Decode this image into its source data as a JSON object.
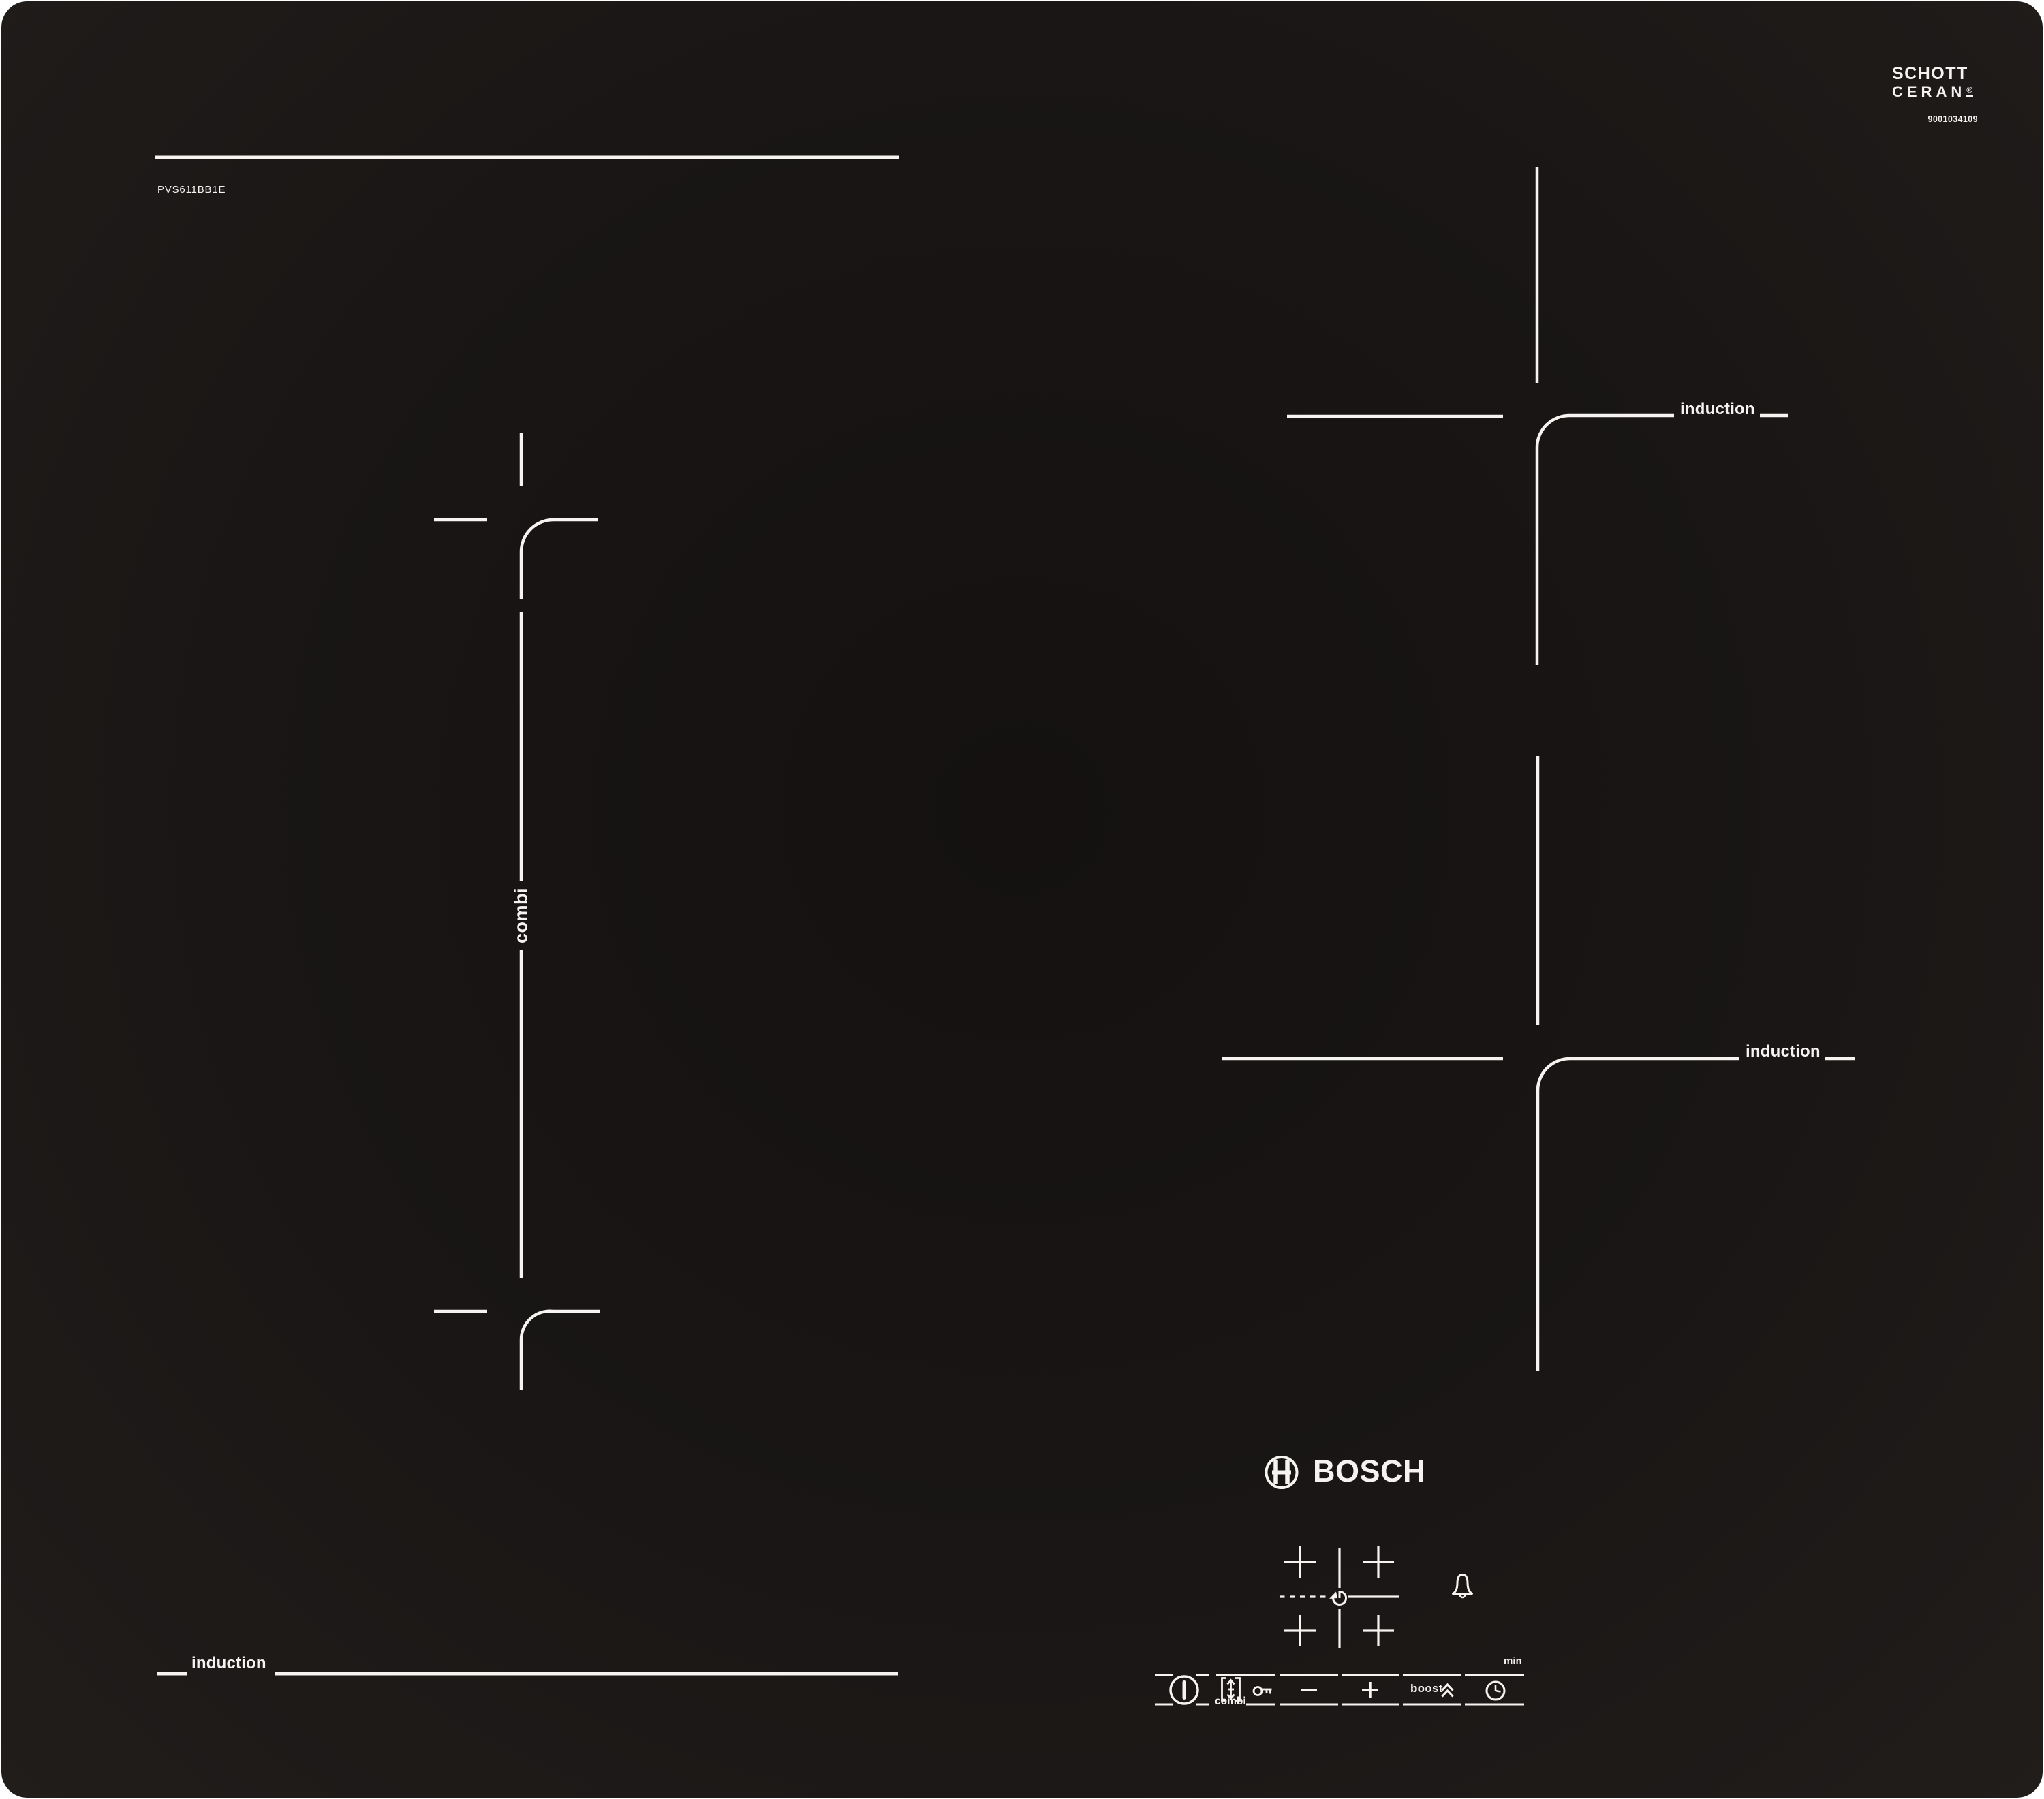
{
  "colors": {
    "page_bg": "#ffffff",
    "panel": "#191615",
    "line": "#f6f4f1"
  },
  "branding": {
    "model": "PVS611BB1E",
    "glass_maker": "SCHOTT",
    "glass_product": "CERAN",
    "registered_mark": "®",
    "serial_code": "9001034109",
    "manufacturer": "BOSCH"
  },
  "zones": {
    "combi_label": "combi",
    "top_right_label": "induction",
    "mid_right_label": "induction",
    "bottom_left_label": "induction"
  },
  "control_panel": {
    "combi_button_label": "combi",
    "boost_button_label": "boost",
    "timer_unit_label": "min",
    "icons": [
      "power-icon",
      "combi-bracket-icon",
      "key-lock-icon",
      "minus-icon",
      "plus-icon",
      "boost-chevrons-icon",
      "timer-clock-icon",
      "bell-icon",
      "zone-layout-icon",
      "rotate-pot-icon",
      "bosch-logo-icon",
      "schott-ceran-logo"
    ]
  }
}
